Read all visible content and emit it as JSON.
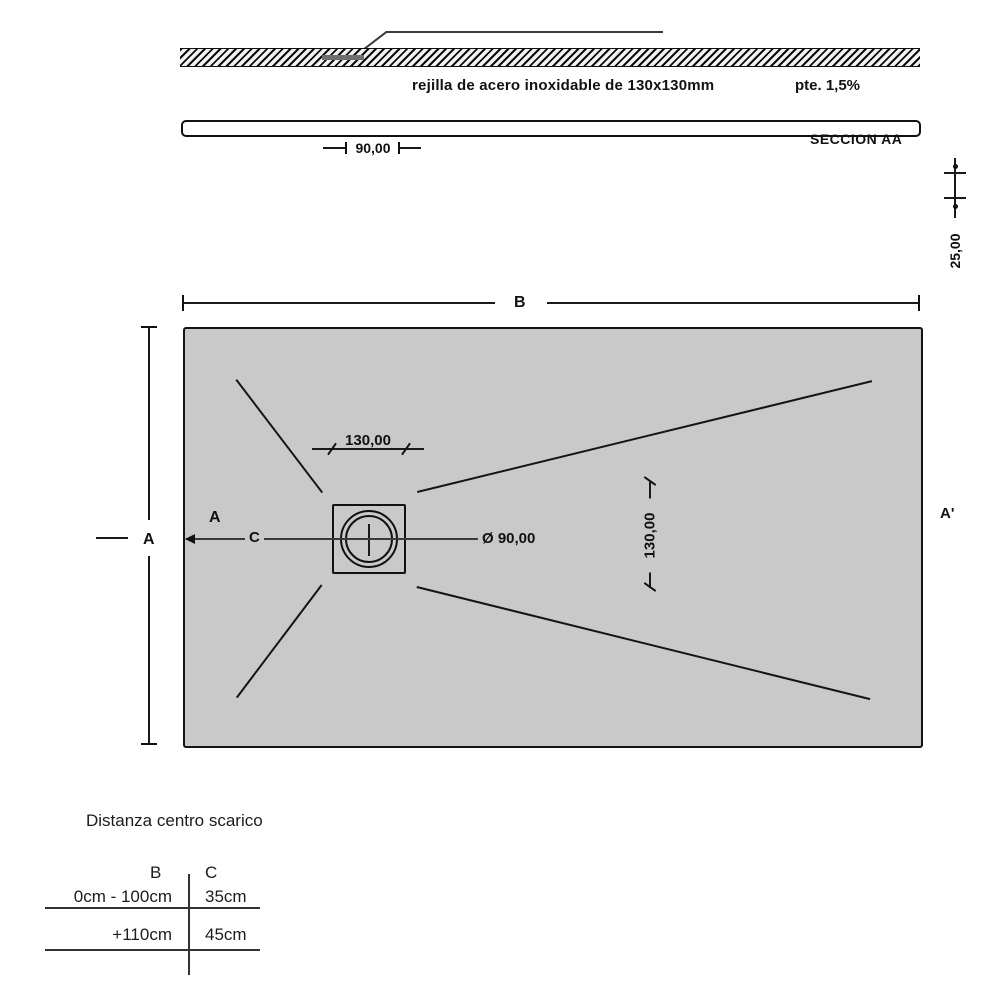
{
  "colors": {
    "tray_fill": "#c9c9c9",
    "line": "#1a1a1a"
  },
  "section_view": {
    "grate_label": "rejilla de acero inoxidable de 130x130mm",
    "slope_label": "pte. 1,5%",
    "section_name": "SECCION AA",
    "grate_width_dim": "90,00",
    "thickness_dim": "25,00"
  },
  "plan_view": {
    "width_dim_label": "B",
    "height_dim_label": "A",
    "section_start_label": "A",
    "drain_offset_label": "C",
    "section_end_label": "A'",
    "drain_width_dim": "130,00",
    "drain_height_dim": "130,00",
    "drain_diameter_dim": "Ø 90,00"
  },
  "table": {
    "title": "Distanza centro scarico",
    "columns": [
      "B",
      "C"
    ],
    "rows": [
      {
        "b": "0cm - 100cm",
        "c": "35cm"
      },
      {
        "b": "+110cm",
        "c": "45cm"
      }
    ]
  }
}
